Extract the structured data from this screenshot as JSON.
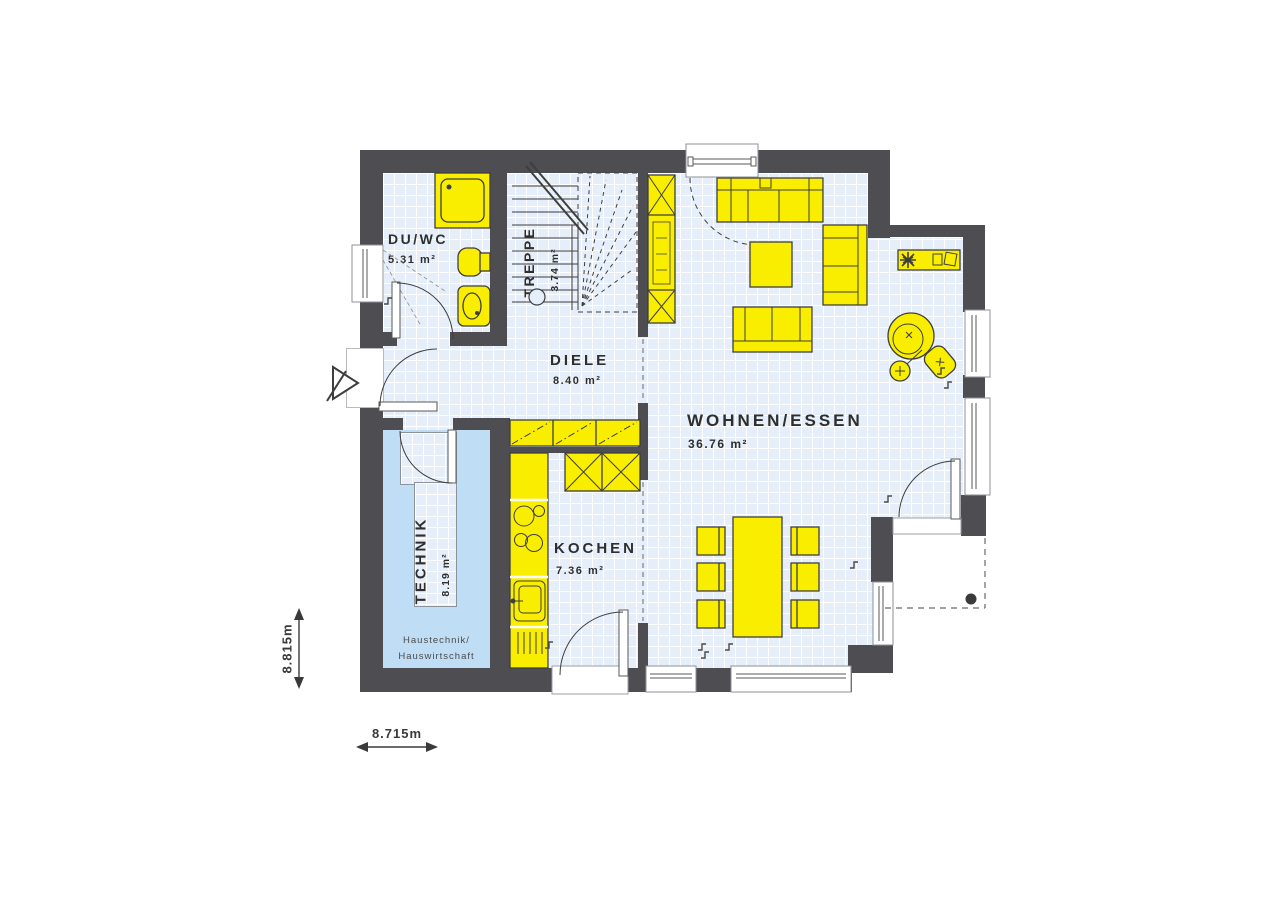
{
  "plan": {
    "rooms": {
      "duwc": {
        "label": "DU/WC",
        "area": "5.31 m²"
      },
      "treppe": {
        "label": "TREPPE",
        "area": "3.74 m²"
      },
      "diele": {
        "label": "DIELE",
        "area": "8.40 m²"
      },
      "wohnen_essen": {
        "label": "WOHNEN/ESSEN",
        "area": "36.76 m²"
      },
      "kochen": {
        "label": "KOCHEN",
        "area": "7.36 m²"
      },
      "technik": {
        "label": "TECHNIK",
        "area": "8.19 m²",
        "sublabel1": "Haustechnik/",
        "sublabel2": "Hauswirtschaft"
      }
    },
    "dimensions": {
      "height": "8.815m",
      "width": "8.715m"
    },
    "colors": {
      "wall": "#4d4d52",
      "furniture_fill": "#f9ee00",
      "outline": "#3e3e3e",
      "floor": "#e6eff9",
      "floor_grid": "#ffffff",
      "technik_floor": "#bfdef6",
      "text": "#2e2e2e"
    },
    "furniture": {
      "duwc": [
        "shower",
        "toilet",
        "washbasin"
      ],
      "diele": [
        "wardrobe-cabinets"
      ],
      "treppe": [
        "winder-staircase"
      ],
      "kochen": [
        "tall-units",
        "worktop",
        "cooktop",
        "sink",
        "dishwasher"
      ],
      "wohnen_essen": [
        "tv-cabinet",
        "sofa-large",
        "sofa-small",
        "coffee-table",
        "lounge-sofa",
        "sideboard",
        "plant",
        "round-chair",
        "floor-lamp",
        "ottoman",
        "dining-table",
        "dining-chairs"
      ],
      "outdoor": [
        "entrance-arrow",
        "terrace",
        "terrace-post"
      ]
    }
  }
}
